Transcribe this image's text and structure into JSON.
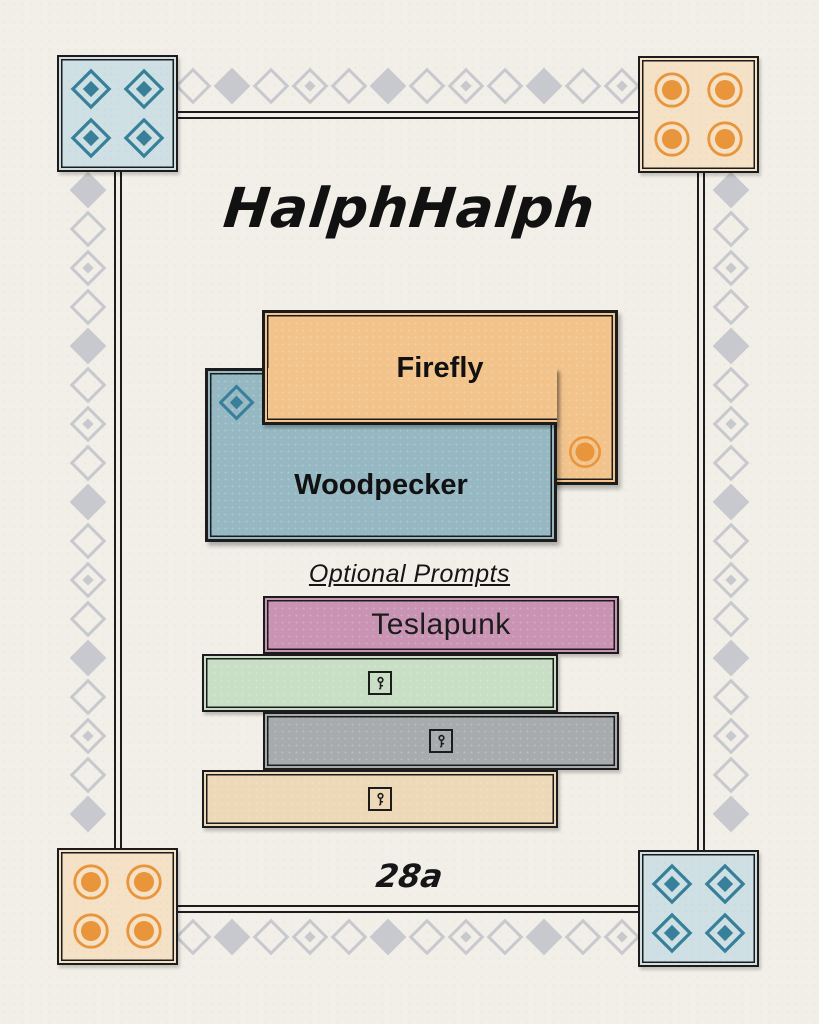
{
  "page": {
    "title": "HalphHalph",
    "page_number": "28a"
  },
  "cards": {
    "firefly": {
      "label": "Firefly"
    },
    "woodpecker": {
      "label": "Woodpecker"
    }
  },
  "prompts": {
    "heading": "Optional Prompts",
    "bars": [
      {
        "label": "Teslapunk",
        "color": "#c994b4",
        "icon": null
      },
      {
        "label": "",
        "color": "#c9dfc5",
        "icon": "key-icon"
      },
      {
        "label": "",
        "color": "#a8abae",
        "icon": "key-icon"
      },
      {
        "label": "",
        "color": "#edd9b7",
        "icon": "key-icon"
      }
    ]
  },
  "corners": {
    "top_left": "diamond",
    "top_right": "circle",
    "bottom_left": "circle",
    "bottom_right": "diamond"
  },
  "colors": {
    "background": "#f2efe8",
    "line": "#1c1c1c",
    "firefly": "#f3c38c",
    "woodpecker": "#96b8c3",
    "corner_blue": "#cfe0e5",
    "corner_tan": "#f5e2c6",
    "motif_teal": "#38809a",
    "motif_orange": "#e8953c",
    "chain_gray": "#c7c9ce"
  }
}
